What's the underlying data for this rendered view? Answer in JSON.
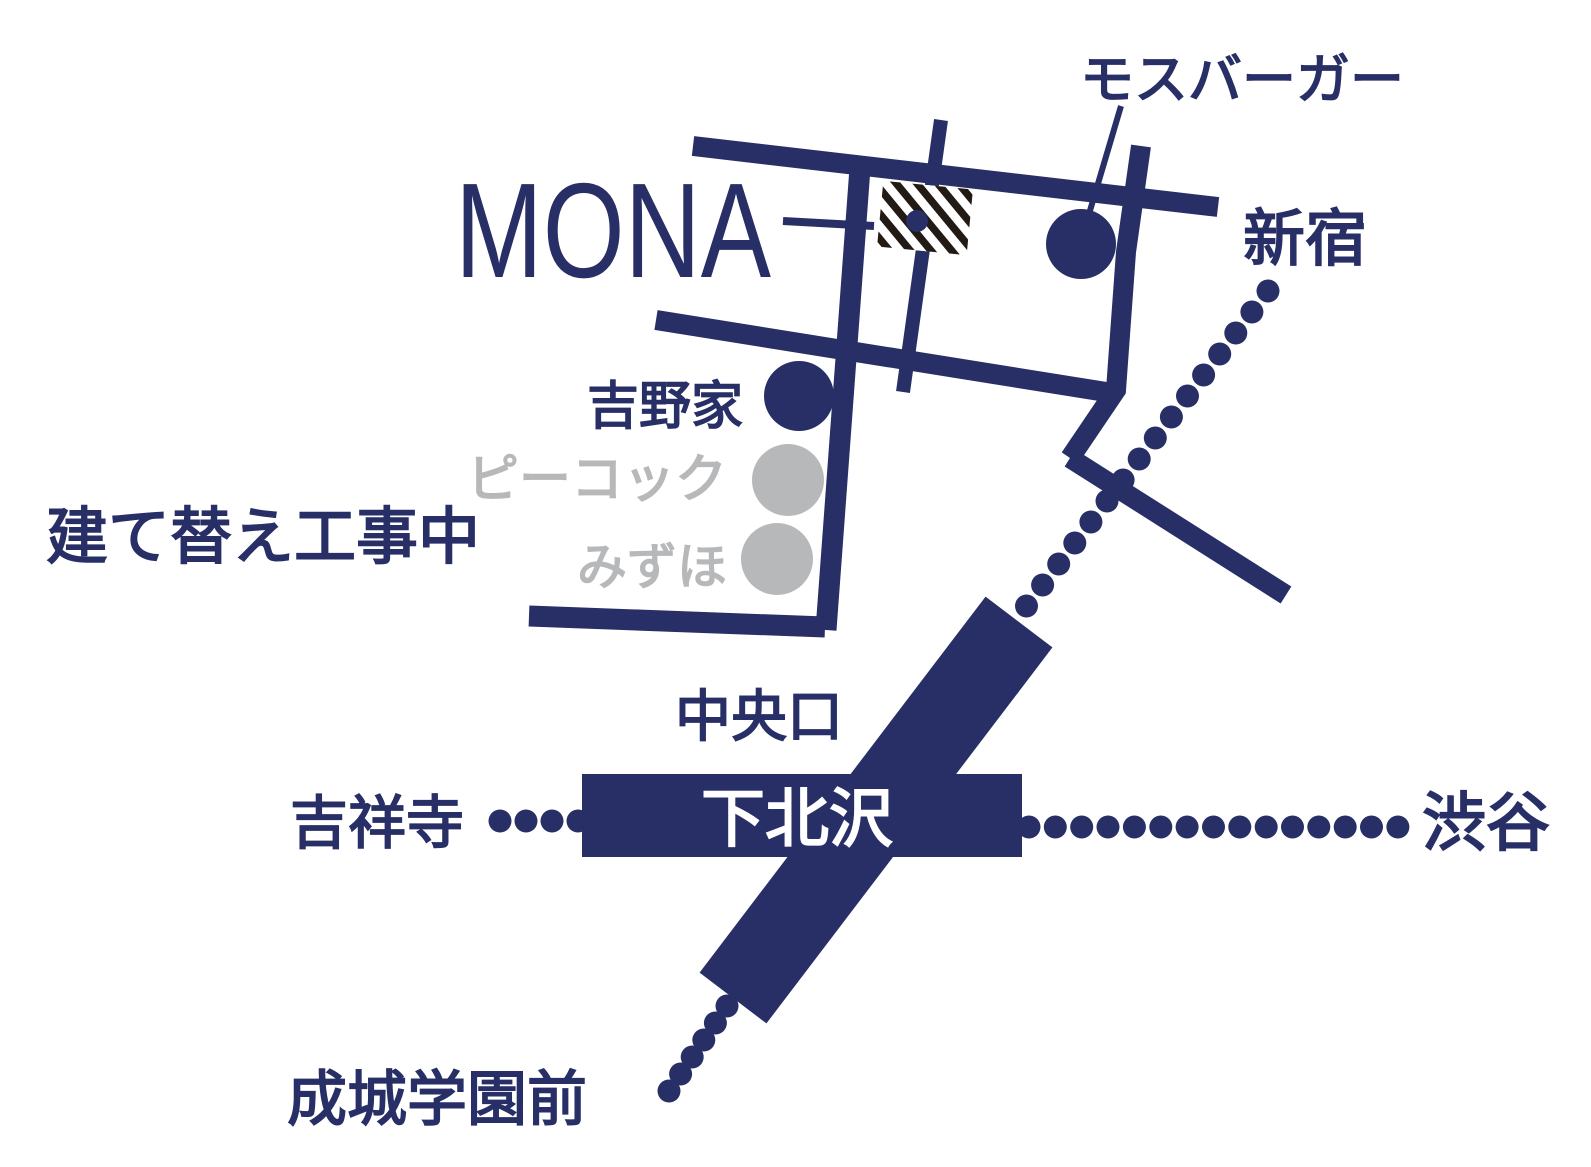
{
  "colors": {
    "navy": "#272f66",
    "gray": "#b7b8ba",
    "hatch_stripe": "#211a15",
    "background": "#ffffff"
  },
  "venue": {
    "name": "MONA"
  },
  "station": {
    "name": "下北沢",
    "exit_label": "中央口"
  },
  "landmarks": [
    {
      "id": "mos-burger",
      "label": "モスバーガー",
      "marker": "filled-circle",
      "color": "navy"
    },
    {
      "id": "yoshinoya",
      "label": "吉野家",
      "marker": "filled-circle",
      "color": "navy"
    },
    {
      "id": "peacock",
      "label": "ピーコック",
      "marker": "filled-circle",
      "color": "gray"
    },
    {
      "id": "mizuho",
      "label": "みずほ",
      "marker": "filled-circle",
      "color": "gray"
    }
  ],
  "annotations": [
    {
      "id": "construction-note",
      "label": "建て替え工事中"
    }
  ],
  "destinations": [
    {
      "id": "shinjuku",
      "label": "新宿"
    },
    {
      "id": "kichijoji",
      "label": "吉祥寺"
    },
    {
      "id": "shibuya",
      "label": "渋谷"
    },
    {
      "id": "seijogakuen-mae",
      "label": "成城学園前"
    }
  ]
}
